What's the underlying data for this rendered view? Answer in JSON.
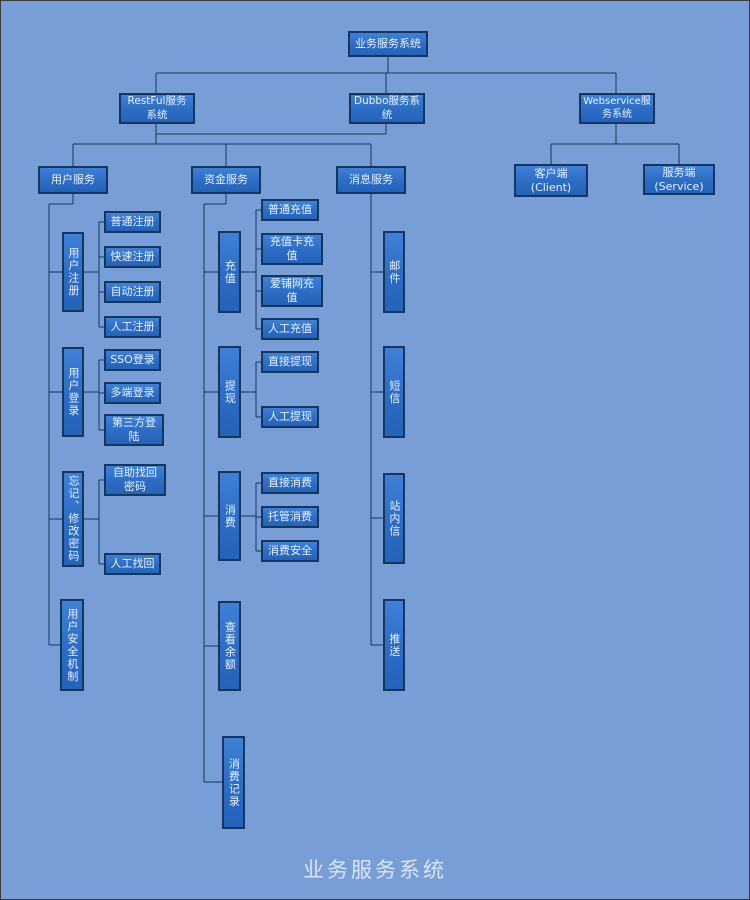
{
  "diagram": {
    "footer_title": "业务服务系统",
    "colors": {
      "background": "#779ed6",
      "node_fill": "#2e71c9",
      "node_border": "#16365c",
      "line": "#16365c",
      "text": "#eaf2fc"
    },
    "nodes": {
      "root": "业务服务系统",
      "restful": "RestFul服务\n系统",
      "dubbo": "Dubbo服务系\n统",
      "webservice": "Webservice服\n务系统",
      "user_service": "用户服务",
      "fund_service": "资金服务",
      "message_service": "消息服务",
      "client": "客户端\n(Client)",
      "server": "服务端\n(Service)",
      "user_register": "用户注册",
      "register_normal": "普通注册",
      "register_fast": "快速注册",
      "register_auto": "自动注册",
      "register_manual": "人工注册",
      "user_login": "用户登录",
      "login_sso": "SSO登录",
      "login_multi": "多端登录",
      "login_third": "第三方登\n陆",
      "forgot_modify_password": "忘记、修改密码",
      "find_back_self": "自助找回\n密码",
      "find_back_manual": "人工找回",
      "user_security": "用户安全机制",
      "recharge": "充值",
      "recharge_normal": "普通充值",
      "recharge_card": "充值卡充\n值",
      "recharge_aipu": "爱铺网充\n值",
      "recharge_manual": "人工充值",
      "withdraw": "提现",
      "withdraw_direct": "直接提现",
      "withdraw_manual": "人工提现",
      "consume": "消费",
      "consume_direct": "直接消费",
      "consume_trust": "托管消费",
      "consume_safe": "消费安全",
      "check_balance": "查看余额",
      "consume_record": "消费记录",
      "mail": "邮件",
      "sms": "短信",
      "site_message": "站内信",
      "push": "推送"
    }
  }
}
